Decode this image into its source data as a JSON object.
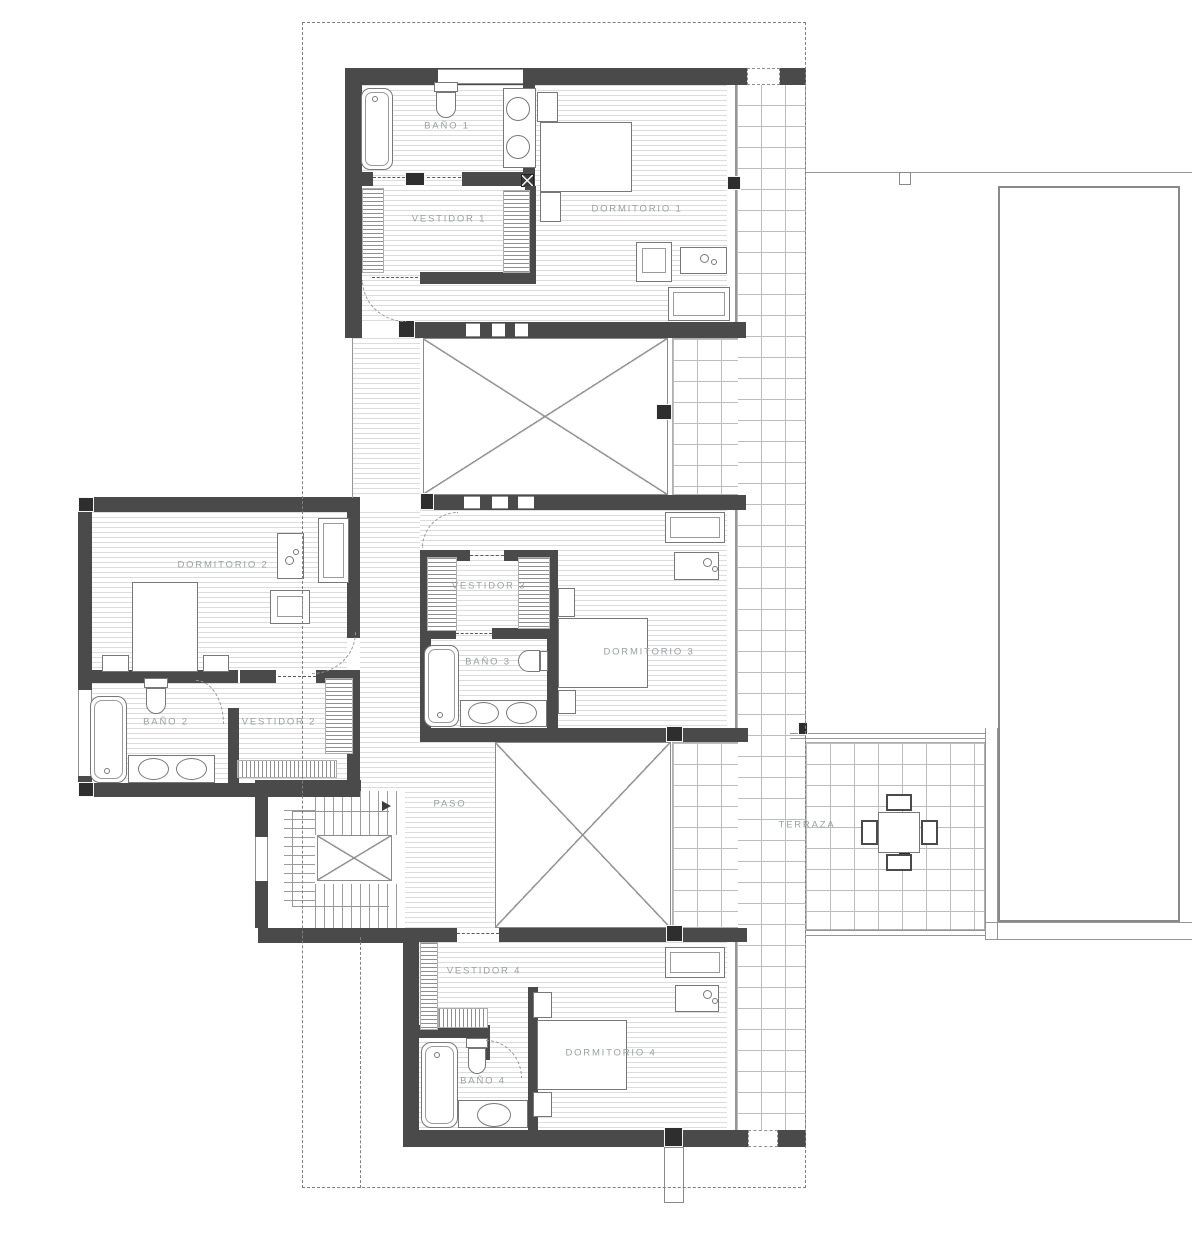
{
  "plan": {
    "rooms": [
      {
        "id": "bano-1",
        "label": "BAÑO 1"
      },
      {
        "id": "vestidor-1",
        "label": "VESTIDOR 1"
      },
      {
        "id": "dormitorio-1",
        "label": "DORMITORIO 1"
      },
      {
        "id": "dormitorio-2",
        "label": "DORMITORIO 2"
      },
      {
        "id": "bano-2",
        "label": "BAÑO 2"
      },
      {
        "id": "vestidor-2",
        "label": "VESTIDOR 2"
      },
      {
        "id": "vestidor-3",
        "label": "VESTIDOR 3"
      },
      {
        "id": "bano-3",
        "label": "BAÑO 3"
      },
      {
        "id": "dormitorio-3",
        "label": "DORMITORIO 3"
      },
      {
        "id": "paso",
        "label": "PASO"
      },
      {
        "id": "terraza",
        "label": "TERRAZA"
      },
      {
        "id": "vestidor-4",
        "label": "VESTIDOR 4"
      },
      {
        "id": "bano-4",
        "label": "BAÑO 4"
      },
      {
        "id": "dormitorio-4",
        "label": "DORMITORIO 4"
      }
    ],
    "colors": {
      "wall": "#4a4a4a",
      "pillar": "#2e2e2e",
      "floor_line": "#dcdcdc",
      "brick_line": "#bdbdbd",
      "outline": "#969696",
      "label_text": "#9aa0a2",
      "background": "#ffffff"
    }
  }
}
